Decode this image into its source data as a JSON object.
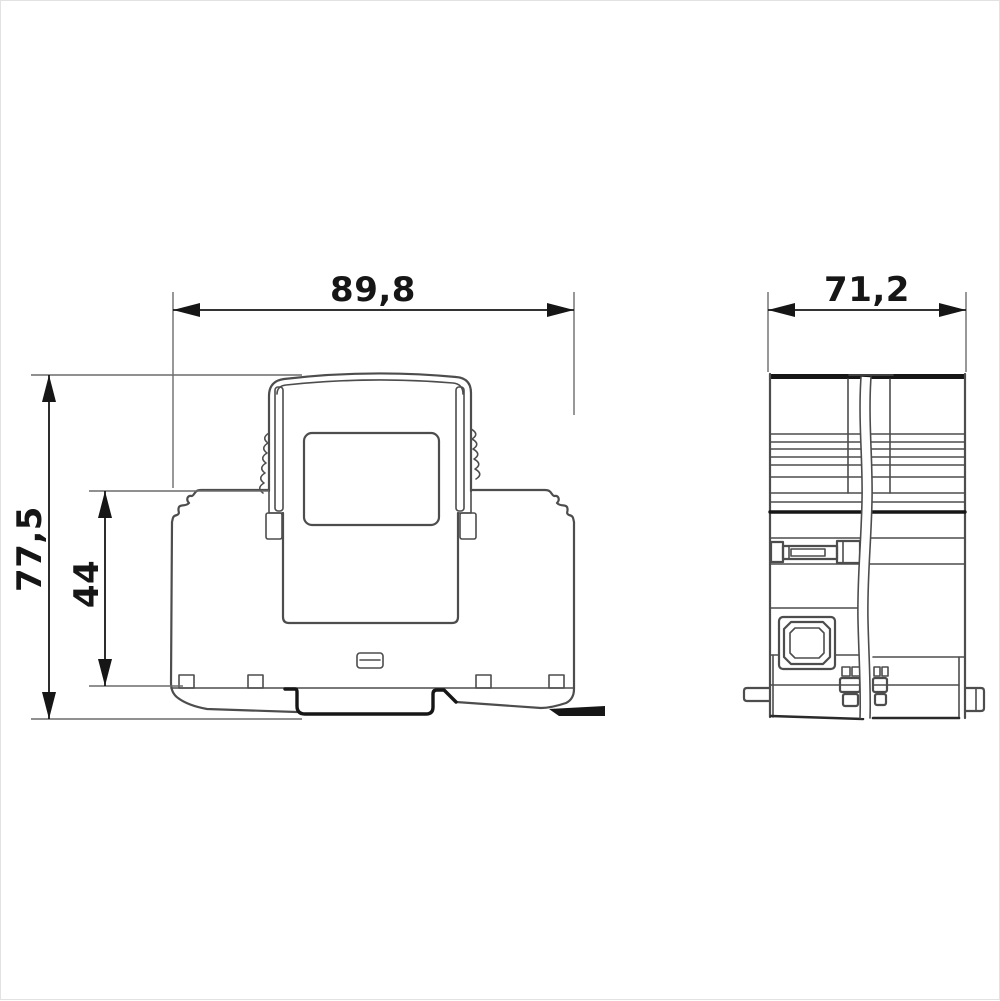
{
  "dimensions": {
    "front_width": "89,8",
    "side_width": "71,2",
    "overall_height": "77,5",
    "rail_height": "44"
  },
  "colors": {
    "line": "#4d4d4d",
    "strong": "#161616",
    "ext": "#6b6b6b",
    "background": "#ffffff",
    "border": "#e2e2e2"
  }
}
